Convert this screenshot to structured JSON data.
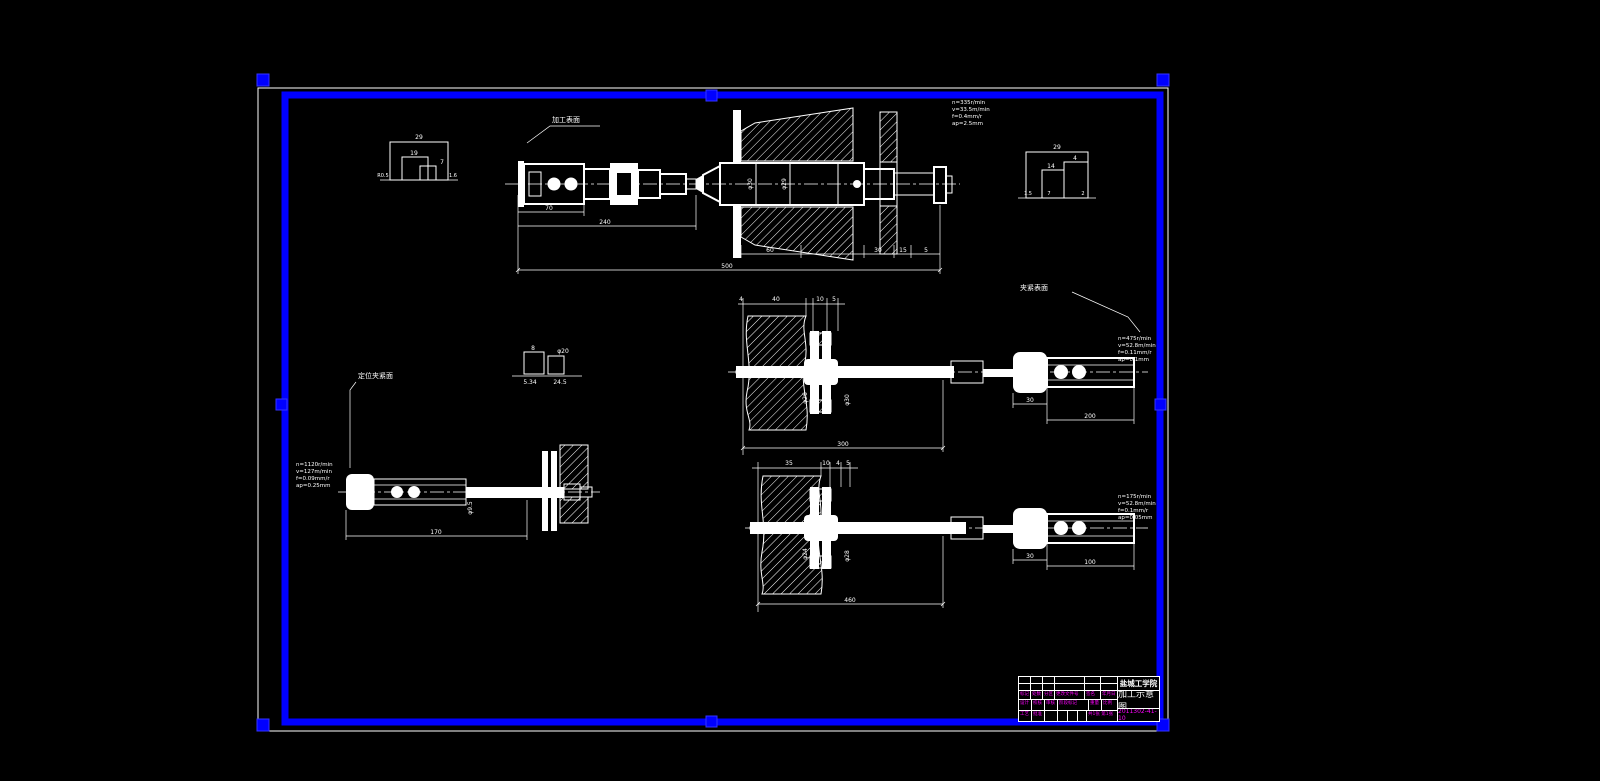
{
  "colors": {
    "frame": "#0000ff",
    "line": "#ffffff",
    "annotation": "#ff00ff",
    "background": "#000000"
  },
  "views": {
    "turning": {
      "surface_label": "加工表面",
      "params": [
        "n=335r/min",
        "v=33.5m/min",
        "f=0.4mm/r",
        "ap=2.5mm"
      ],
      "dims": {
        "len1": "70",
        "len2": "240",
        "total": "500",
        "seg1": "60",
        "seg2": "30",
        "seg3": "15",
        "seg4": "5",
        "dia1": "φ30",
        "dia2": "φ29"
      }
    },
    "grind_upper": {
      "surface_label": "夹紧表面",
      "params": [
        "n=475r/min",
        "v=52.8m/min",
        "f=0.11mm/r",
        "ap=0.1mm"
      ],
      "dims": {
        "s1": "4",
        "s2": "40",
        "s3": "10",
        "s4": "5",
        "total": "300",
        "sub1": "30",
        "sub2": "200",
        "dia1": "φ26",
        "dia2": "φ30"
      }
    },
    "grind_lower": {
      "params": [
        "n=175r/min",
        "v=52.8m/min",
        "f=0.1mm/r",
        "ap=0.05mm"
      ],
      "dims": {
        "s1": "35",
        "s2": "10",
        "s3": "4",
        "s4": "5",
        "total": "460",
        "sub1": "30",
        "sub2": "100",
        "dia1": "φ24",
        "dia2": "φ28"
      }
    },
    "grind_left": {
      "surface_label": "定位夹紧面",
      "params": [
        "n=1120r/min",
        "v=127m/min",
        "f=0.09mm/r",
        "ap=0.25mm"
      ],
      "dims": {
        "total": "170",
        "dia1": "φ9.5"
      }
    }
  },
  "details": {
    "d1": {
      "t1": "29",
      "t2": "19",
      "t3": "7",
      "t4": "R0.5",
      "t5": "1.6"
    },
    "d2": {
      "t1": "29",
      "t2": "14",
      "t3": "4",
      "t4": "1.5",
      "t5": "7",
      "t6": "2"
    },
    "d3": {
      "t1": "8",
      "t2": "φ20",
      "t3": "5.34",
      "t4": "24.5"
    }
  },
  "titleblock": {
    "school": "盐城工学院",
    "drawing_title": "加工示意图",
    "drawing_number": "2011302-41-10",
    "marks": [
      "标记",
      "处数",
      "分区",
      "更改文件号",
      "签名",
      "年月日"
    ],
    "roles": [
      "设计",
      "校核",
      "审核",
      "工艺",
      "批准"
    ],
    "stage_label": "阶段标记",
    "weight_label": "重量",
    "scale_label": "比例",
    "sheet_label": "共1张 第1张"
  }
}
